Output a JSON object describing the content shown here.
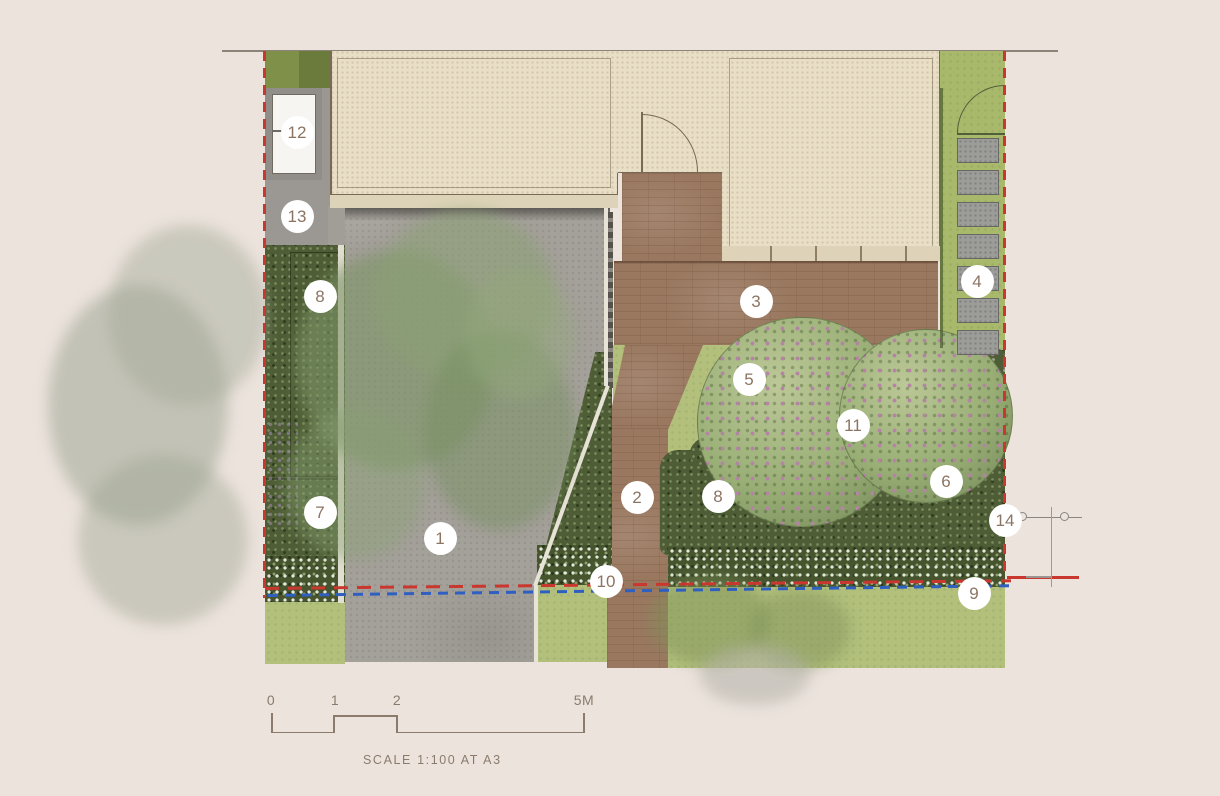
{
  "markers": [
    {
      "label": "1",
      "x": 440,
      "y": 538
    },
    {
      "label": "2",
      "x": 637,
      "y": 497
    },
    {
      "label": "3",
      "x": 756,
      "y": 301
    },
    {
      "label": "4",
      "x": 977,
      "y": 281
    },
    {
      "label": "5",
      "x": 749,
      "y": 379
    },
    {
      "label": "6",
      "x": 946,
      "y": 481
    },
    {
      "label": "7",
      "x": 320,
      "y": 512
    },
    {
      "label": "8",
      "x": 320,
      "y": 296
    },
    {
      "label": "8",
      "x": 718,
      "y": 496
    },
    {
      "label": "9",
      "x": 974,
      "y": 593
    },
    {
      "label": "10",
      "x": 606,
      "y": 581
    },
    {
      "label": "11",
      "x": 853,
      "y": 425
    },
    {
      "label": "12",
      "x": 297,
      "y": 132
    },
    {
      "label": "13",
      "x": 297,
      "y": 216
    },
    {
      "label": "14",
      "x": 1005,
      "y": 520
    }
  ],
  "scale_bar": {
    "tick_labels": [
      {
        "text": "0",
        "x": 271
      },
      {
        "text": "1",
        "x": 335
      },
      {
        "text": "2",
        "x": 397
      },
      {
        "text": "5M",
        "x": 584
      }
    ],
    "caption": "SCALE 1:100 AT A3"
  },
  "colors": {
    "page_bg": "#ece3dd",
    "plan_line": "#8d8379",
    "building_fill": "#e9dfc6",
    "building_outline": "#7a6a55",
    "paving_brown": "#9a7860",
    "driveway_gray": "#a4a09a",
    "lawn_green": "#b2c07c",
    "strip_lawn": "#a9b96c",
    "planting_dark": "#4e5d35",
    "flower_pink": "#b583a5",
    "stone_gray": "#9c9c99",
    "curb_white": "#e8e3d7",
    "boundary_red": "#c9372e",
    "service_blue": "#2f5fc0",
    "marker_text": "#8c7462",
    "scale_text": "#8b7b6c"
  }
}
